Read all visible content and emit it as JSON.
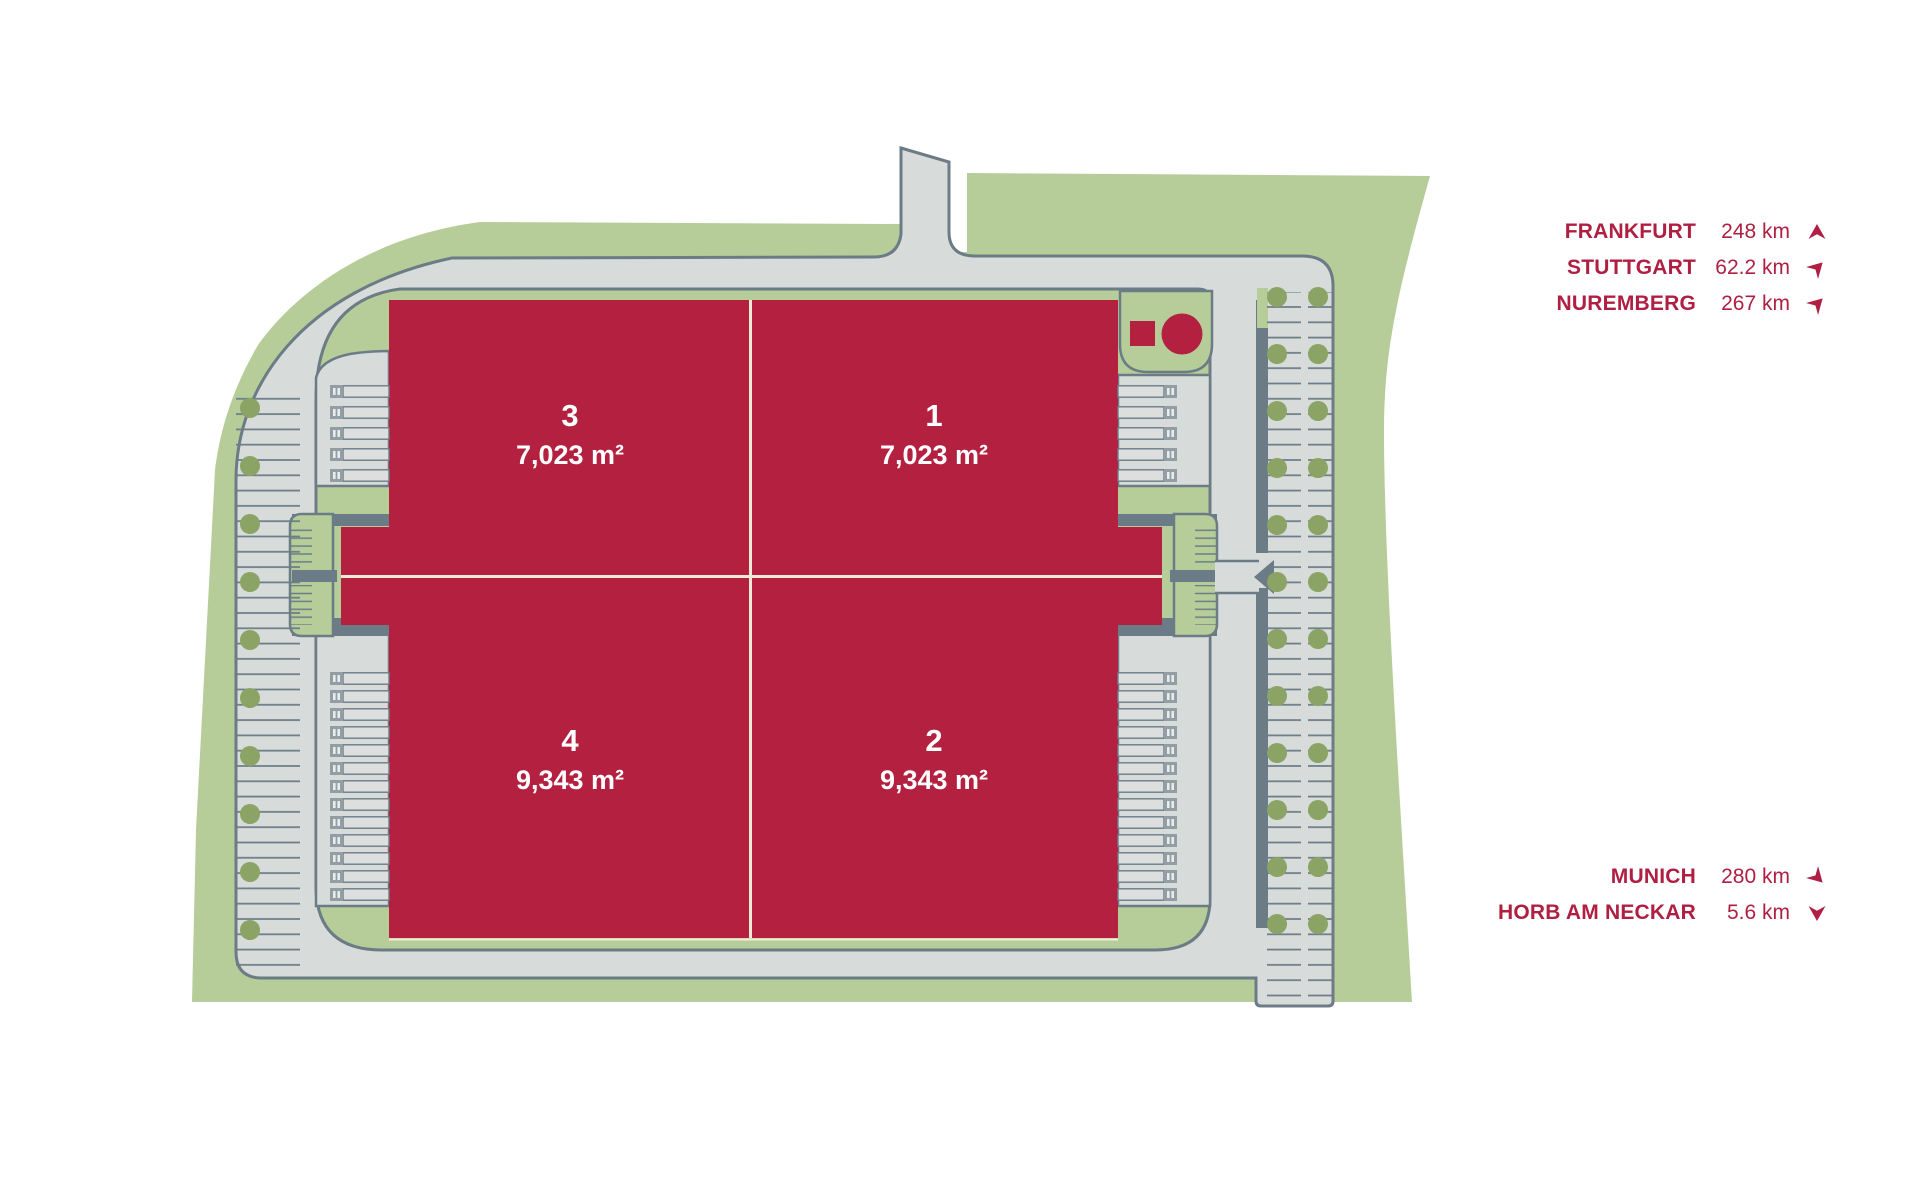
{
  "map": {
    "units": {
      "u3": {
        "number": "3",
        "area": "7,023 m²"
      },
      "u1": {
        "number": "1",
        "area": "7,023 m²"
      },
      "u4": {
        "number": "4",
        "area": "9,343 m²"
      },
      "u2": {
        "number": "2",
        "area": "9,343 m²"
      }
    }
  },
  "routes": {
    "frankfurt": {
      "city": "FRANKFURT",
      "distance": "248 km",
      "direction": "north"
    },
    "stuttgart": {
      "city": "STUTTGART",
      "distance": "62.2 km",
      "direction": "northeast"
    },
    "nuremberg": {
      "city": "NUREMBERG",
      "distance": "267 km",
      "direction": "northeast"
    },
    "munich": {
      "city": "MUNICH",
      "distance": "280 km",
      "direction": "southeast"
    },
    "horb": {
      "city": "HORB AM NECKAR",
      "distance": "5.6 km",
      "direction": "south"
    }
  },
  "colors": {
    "site_green": "#b6cd99",
    "pavement": "#d7dbd9",
    "outline": "#6b7c87",
    "building_red": "#b32040",
    "tree_green": "#8ba364",
    "label_red": "#b01f42",
    "divider_cream": "#f1ead8"
  }
}
